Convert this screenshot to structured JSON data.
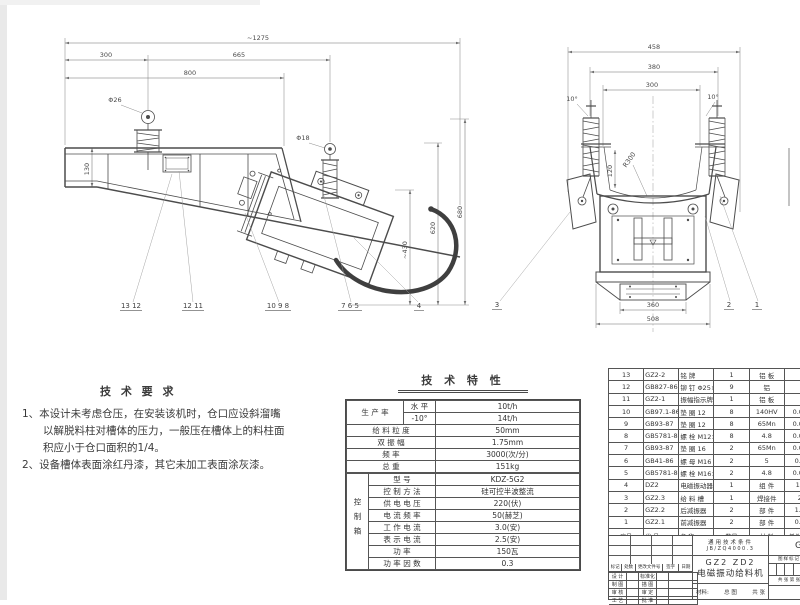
{
  "palette": {
    "line": "#4a4a4a",
    "dim_line": "#6f6f6f",
    "text": "#3c3c3c",
    "cable": "#3f3f3f",
    "scan_edge": "#e9e9e9"
  },
  "side_view": {
    "dims": {
      "total_length": "~1275",
      "front_overhang": "300",
      "hanger_span": "665",
      "trough_length": "800",
      "trough_height": "130",
      "front_ring": "Φ26",
      "rear_ring": "Φ18",
      "height_1": "~430",
      "height_2": "620",
      "height_3": "680"
    },
    "callouts": [
      "13 12",
      "12 11",
      "10 9 8",
      "7 6 5",
      "4"
    ]
  },
  "front_view": {
    "dims": {
      "overall_width": "458",
      "spring_span": "380",
      "trough_width": "300",
      "trough_depth": "120",
      "bottom_radius": "R300",
      "left_angle": "10°",
      "right_angle": "10°",
      "base_width": "360",
      "outer_width": "508"
    },
    "callouts": [
      "3",
      "2",
      "1"
    ]
  },
  "tech_requirements": {
    "title": "技 术 要 求",
    "lines": [
      {
        "t": "1、本设计未考虑仓压，在安装该机时，仓口应设斜溜嘴"
      },
      {
        "t": "以解脱料柱对槽体的压力，一般压在槽体上的料柱面"
      },
      {
        "t": "积应小于仓口面积的1/4。"
      },
      {
        "t": "2、设备槽体表面涂红丹漆，其它未加工表面涂灰漆。"
      }
    ]
  },
  "tech_table": {
    "title": "技 术 特 性",
    "production": {
      "label": "生 产 率",
      "rows": [
        {
          "cond": "水  平",
          "value": "10t/h"
        },
        {
          "cond": "-10°",
          "value": "14t/h"
        }
      ]
    },
    "rows": [
      {
        "label": "给 料 粒 度",
        "value": "50mm"
      },
      {
        "label": "双   振   幅",
        "value": "1.75mm"
      },
      {
        "label": "频        率",
        "value": "3000(次/分)"
      },
      {
        "label": "总        重",
        "value": "151kg"
      }
    ],
    "control": {
      "label": "控制箱",
      "rows": [
        {
          "k": "型      号",
          "v": "KDZ-5G2"
        },
        {
          "k": "控 制 方 法",
          "v": "硅可控半波整流"
        },
        {
          "k": "供 电 电 压",
          "v": "220(伏)"
        },
        {
          "k": "电 流 频 率",
          "v": "50(赫芝)"
        },
        {
          "k": "工 作 电 流",
          "v": "3.0(安)"
        },
        {
          "k": "表 示 电 流",
          "v": "2.5(安)"
        },
        {
          "k": "功      率",
          "v": "150瓦"
        },
        {
          "k": "功 率 因 数",
          "v": "0.3"
        }
      ]
    }
  },
  "parts_list": {
    "header": [
      "序号",
      "代    号",
      "名        称",
      "数量",
      "材 料",
      "单件 重量"
    ],
    "rows": [
      [
        "13",
        "GZ2-2",
        "铭  牌",
        "1",
        "铝 板",
        "-"
      ],
      [
        "12",
        "GB827-86",
        "铆 钉 Φ25×5",
        "9",
        "铝",
        "-"
      ],
      [
        "11",
        "GZ2-1",
        "振幅指示牌",
        "1",
        "铝 板",
        "-"
      ],
      [
        "10",
        "GB97.1-86",
        "垫 圈 12",
        "8",
        "140HV",
        "0.003"
      ],
      [
        "9",
        "GB93-87",
        "垫 圈 12",
        "8",
        "65Mn",
        "0.002"
      ],
      [
        "8",
        "GB5781-86",
        "螺 栓 M12×25",
        "8",
        "4.8",
        "0.011"
      ],
      [
        "7",
        "GB93-87",
        "垫 圈 16",
        "2",
        "65Mn",
        "0.007"
      ],
      [
        "6",
        "GB41-86",
        "螺 母 M16",
        "2",
        "5",
        "0.34"
      ],
      [
        "5",
        "GB5781-82",
        "螺 栓 M16×35",
        "2",
        "4.8",
        "0.065"
      ],
      [
        "4",
        "DZ2",
        "电磁振动器",
        "1",
        "组 件",
        "124"
      ],
      [
        "3",
        "GZ2.3",
        "给 料 槽",
        "1",
        "焊接件",
        "22"
      ],
      [
        "2",
        "GZ2.2",
        "后减振器",
        "2",
        "部 件",
        "1.52"
      ],
      [
        "1",
        "GZ2.1",
        "前减振器",
        "2",
        "部 件",
        "0.93"
      ]
    ]
  },
  "title_block": {
    "note_line1": "通用技术条件",
    "note_line2": "JB/ZQ4000.3",
    "model": "GZ2  ZD2",
    "product_name": "电磁振动给料机",
    "material_label": "材料:",
    "view_label": "总 图",
    "pages_label": "共 张",
    "rev_header": [
      "标记",
      "处数",
      "更改文件号",
      "签字",
      "日期"
    ],
    "sign_left": [
      "设 计",
      "制 图",
      "审 核",
      "工 艺"
    ],
    "sign_right": [
      "标准化",
      "描 图",
      "审 定",
      "批 准"
    ],
    "mark_label": "图样标记",
    "sheet_label": "共 张 第 张",
    "drawing_no_partial": "GZ"
  }
}
